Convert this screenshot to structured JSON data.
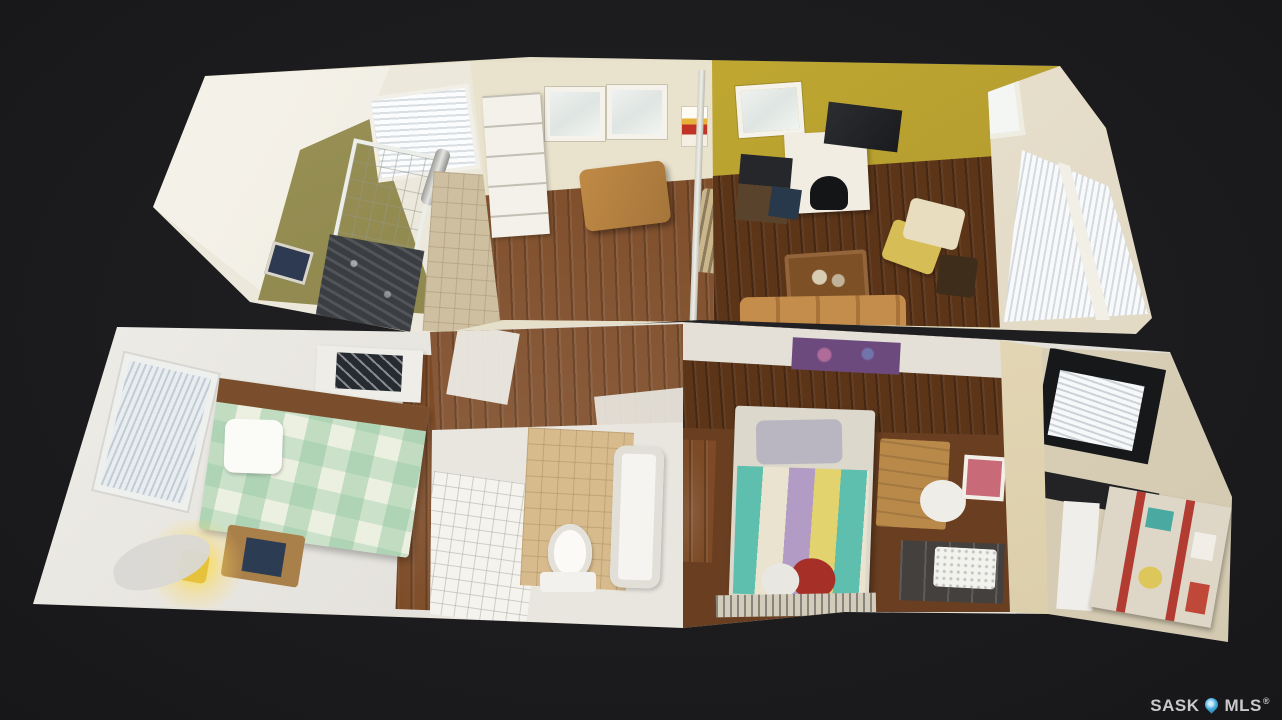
{
  "viewer": {
    "view_mode": "dollhouse-3d",
    "background_color": "#1c1c1e"
  },
  "watermark": {
    "brand_prefix": "SASK",
    "brand_suffix": "MLS",
    "registered_symbol": "®",
    "text_color": "#c9c9c9",
    "pin_color": "#43a9da",
    "pin_icon": "map-pin-icon"
  },
  "floorplan": {
    "rooms": [
      {
        "name": "kitchen",
        "wall_color": "#8f874f",
        "floor_color": "#cdbfa0"
      },
      {
        "name": "dining-room",
        "wall_color": "#e9e2cc",
        "floor_color": "#8a5226"
      },
      {
        "name": "living-room",
        "wall_color": "#bba22e",
        "floor_color": "#6e4123"
      },
      {
        "name": "sunroom",
        "wall_color": "#ece5d4"
      },
      {
        "name": "bedroom-1",
        "wall_color": "#e9e7e2",
        "quilt_color": "#dfe8d2"
      },
      {
        "name": "bathroom",
        "floor_color": "#d7bb8d"
      },
      {
        "name": "bedroom-2",
        "floor_color": "#6a3f21",
        "quilt_colors": [
          "#5fbfae",
          "#b29cc6",
          "#e9e3cf",
          "#e3d36e"
        ]
      },
      {
        "name": "office-nook",
        "wall_color": "#ded5c2",
        "accent_color": "#b23c32"
      }
    ]
  }
}
